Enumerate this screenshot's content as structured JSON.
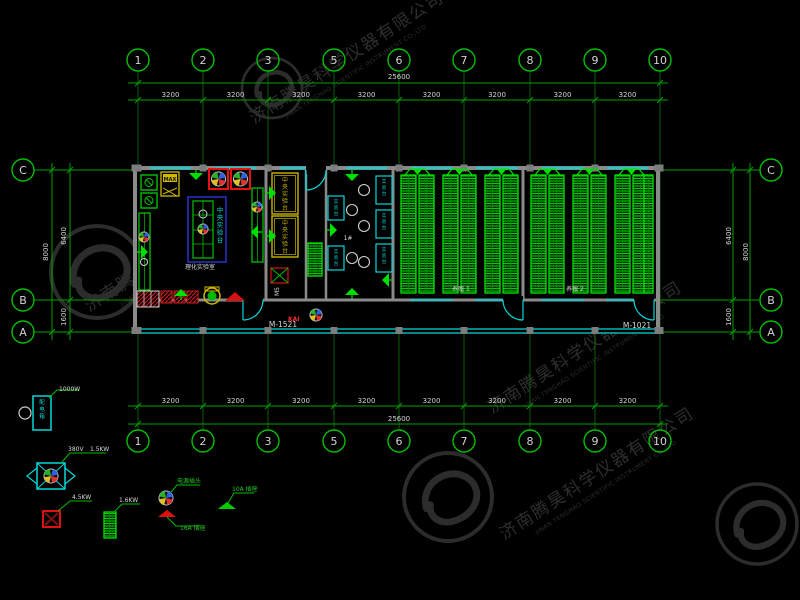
{
  "watermark": {
    "cn": "济南腾昊科学仪器有限公司",
    "en": "JINAN TENGHAO SCIENTIFIC INSTRUMENT CO.,LTD"
  },
  "axes": {
    "cols": [
      "1",
      "2",
      "3",
      "5",
      "6",
      "7",
      "8",
      "9",
      "10"
    ],
    "rows": [
      "C",
      "B",
      "A"
    ],
    "bay_dim": "3200",
    "total_dim": "25600",
    "side_total_dim": "8000",
    "side_upper_dim": "6400",
    "side_lower_dim": "1600"
  },
  "plan": {
    "door_left": "M-1521",
    "door_right": "M-1021",
    "door_tag": "M5",
    "room_lab": "理化实验室",
    "room_mid": "1#",
    "room_rear1": "养殖 1",
    "room_rear2": "养殖 2",
    "bench_text": "中央实验台",
    "side_bench_text": "实验台",
    "cabinet_text": "MAX",
    "red_tag": "KAI",
    "panel_text": "配电箱"
  },
  "legend": {
    "power1": "1000W",
    "volt": "380V",
    "power2": "1.5KW",
    "power3": "4.5KW",
    "power4": "1.6KW",
    "plug": "电源插头",
    "socket16": "16A  插座",
    "socket10": "10A  插座"
  },
  "colors": {
    "green": "#00c000",
    "bright_green": "#00e000",
    "cyan": "#00d8d8",
    "red": "#dd1111",
    "yellow": "#d0b800",
    "blue": "#2233cc",
    "wall": "#8a8a8a",
    "dim_line": "#00a000",
    "dim_text": "#d4d4d4",
    "watermark": "#2c2c2c"
  }
}
